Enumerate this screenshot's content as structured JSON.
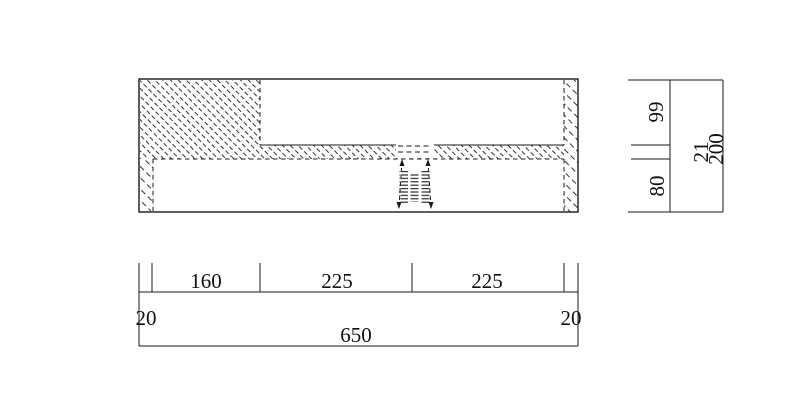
{
  "drawing": {
    "kind": "technical-section-drawing",
    "background": "#ffffff",
    "line_color": "#1a1a1a"
  },
  "dims": {
    "bottom": {
      "left_margin": "20",
      "seg1": "160",
      "seg2": "225",
      "seg3": "225",
      "right_margin": "20",
      "overall": "650"
    },
    "right": {
      "top": "99",
      "mid": "21",
      "bottom": "80",
      "overall": "200"
    }
  }
}
